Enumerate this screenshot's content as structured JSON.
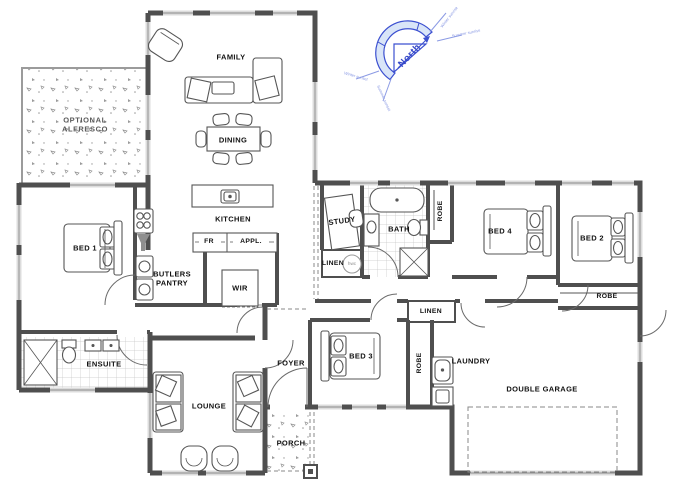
{
  "rooms": {
    "family": "FAMILY",
    "dining": "DINING",
    "kitchen": "KITCHEN",
    "optional_alfresco": "OPTIONAL\nALFRESCO",
    "bed1": "BED 1",
    "butlers_pantry": "BUTLERS\nPANTRY",
    "fridge": "FR",
    "appliances": "APPL.",
    "wir": "WIR",
    "study": "STUDY",
    "bath": "BATH",
    "robe_bath": "ROBE",
    "linen_hwc": "LINEN",
    "hwc": "hwc",
    "bed4": "BED 4",
    "bed2": "BED 2",
    "robe_bed2": "ROBE",
    "linen_hall": "LINEN",
    "bed3": "BED 3",
    "robe_bed3": "ROBE",
    "laundry": "LAUNDRY",
    "garage": "DOUBLE GARAGE",
    "ensuite": "ENSUITE",
    "lounge": "LOUNGE",
    "foyer": "FOYER",
    "porch": "PORCH"
  },
  "compass": {
    "north": "North",
    "rays": {
      "ne": "Winter sunrise",
      "e": "Summer sunrise",
      "w": "Winter sunset",
      "sw": "Summer sunset"
    }
  },
  "colors": {
    "wall": "#4f4f4f",
    "window": "#dcdcdc",
    "compass_blue": "#3c50d0",
    "paper": "#ffffff"
  }
}
